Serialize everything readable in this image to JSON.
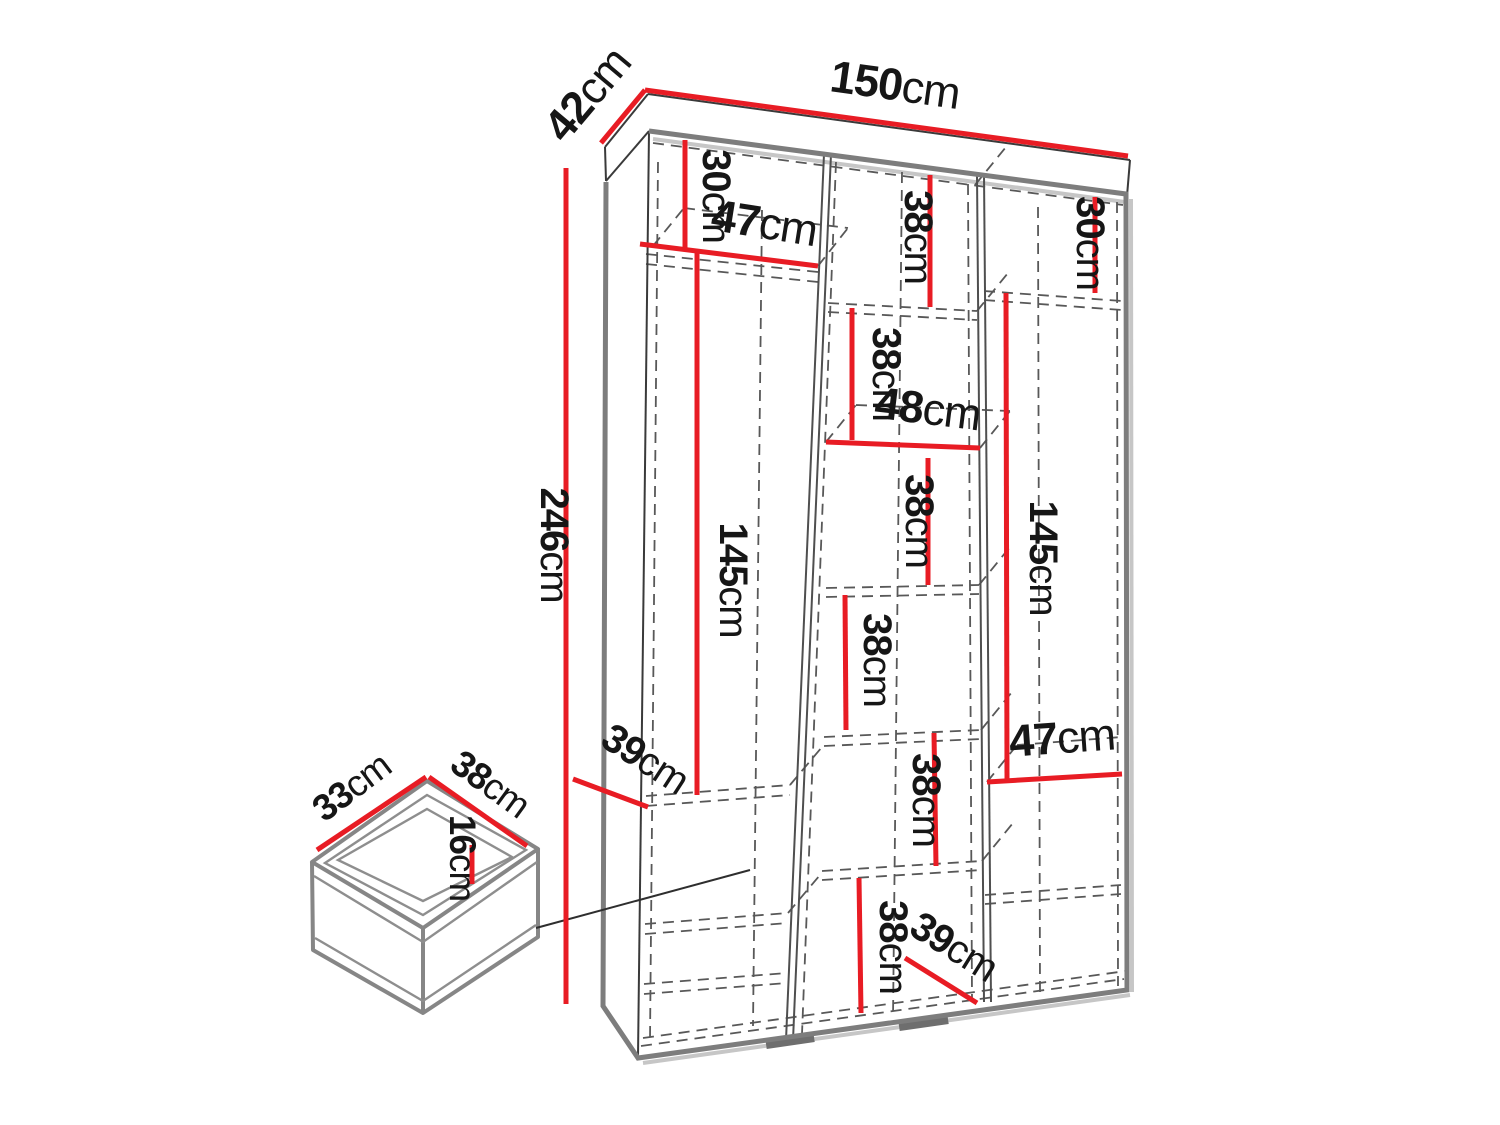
{
  "diagram_type": "furniture-dimension-diagram",
  "subject": "three-column wardrobe with internal shelves and a drawer detail",
  "colors": {
    "dimension_line": "#e81c24",
    "outline": "#7d7d7d",
    "text": "#161616",
    "hidden_edges": "#585858",
    "background": "#ffffff"
  },
  "wardrobe": {
    "width_cm": 150,
    "depth_cm": 42,
    "height_cm": 246,
    "interior_depth_cm": 39,
    "left_column": {
      "top_section_height_cm": 30,
      "shelf_width_cm": 47,
      "hanging_height_cm": 145,
      "depth_cm": 39
    },
    "middle_column": {
      "shelf_width_cm": 48,
      "section_heights_cm": [
        38,
        38,
        38,
        38,
        38,
        38
      ],
      "depth_cm": 39
    },
    "right_column": {
      "top_section_height_cm": 30,
      "hanging_height_cm": 145,
      "shelf_width_cm": 47
    }
  },
  "drawer": {
    "depth_cm": 33,
    "width_cm": 38,
    "height_cm": 16
  },
  "labels": [
    {
      "id": "wardrobe-width",
      "num": "150",
      "unit": "cm"
    },
    {
      "id": "wardrobe-depth",
      "num": "42",
      "unit": "cm"
    },
    {
      "id": "wardrobe-height",
      "num": "246",
      "unit": "cm"
    },
    {
      "id": "left-top-height",
      "num": "30",
      "unit": "cm"
    },
    {
      "id": "left-shelf-width",
      "num": "47",
      "unit": "cm"
    },
    {
      "id": "mid-section-1",
      "num": "38",
      "unit": "cm"
    },
    {
      "id": "mid-section-2",
      "num": "38",
      "unit": "cm"
    },
    {
      "id": "mid-shelf-width",
      "num": "48",
      "unit": "cm"
    },
    {
      "id": "mid-section-3",
      "num": "38",
      "unit": "cm"
    },
    {
      "id": "left-hanging-height",
      "num": "145",
      "unit": "cm"
    },
    {
      "id": "right-hanging-height",
      "num": "145",
      "unit": "cm"
    },
    {
      "id": "right-top-height",
      "num": "30",
      "unit": "cm"
    },
    {
      "id": "mid-section-4",
      "num": "38",
      "unit": "cm"
    },
    {
      "id": "mid-section-5",
      "num": "38",
      "unit": "cm"
    },
    {
      "id": "mid-section-6",
      "num": "38",
      "unit": "cm"
    },
    {
      "id": "left-interior-depth",
      "num": "39",
      "unit": "cm"
    },
    {
      "id": "right-shelf-width",
      "num": "47",
      "unit": "cm"
    },
    {
      "id": "mid-interior-depth",
      "num": "39",
      "unit": "cm"
    },
    {
      "id": "drawer-depth",
      "num": "33",
      "unit": "cm"
    },
    {
      "id": "drawer-width",
      "num": "38",
      "unit": "cm"
    },
    {
      "id": "drawer-height",
      "num": "16",
      "unit": "cm"
    }
  ]
}
